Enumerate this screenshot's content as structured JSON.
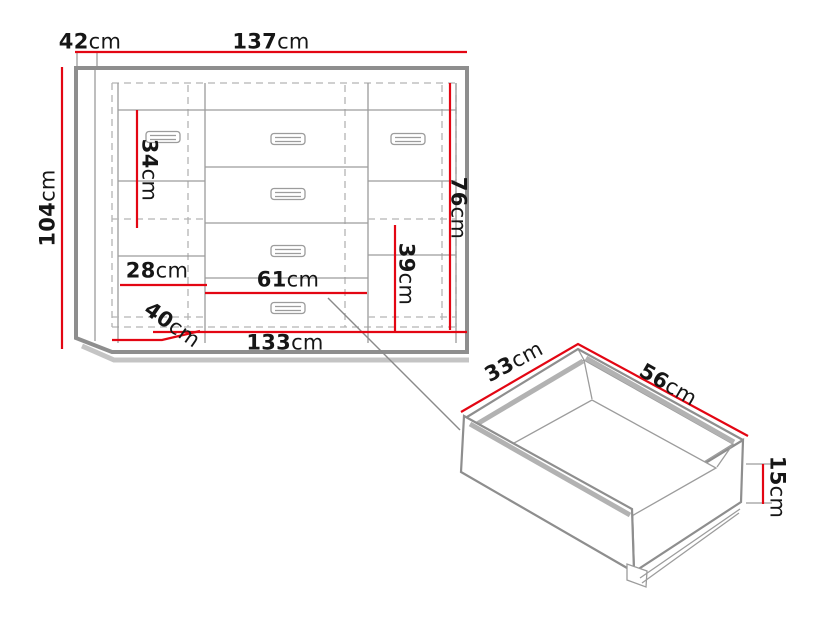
{
  "colors": {
    "dimension_line": "#e30613",
    "outline": "#8e8e8e",
    "label_text": "#161616"
  },
  "cabinet": {
    "dims": {
      "top_depth": {
        "value": "42",
        "unit": "cm"
      },
      "total_width": {
        "value": "137",
        "unit": "cm"
      },
      "total_height": {
        "value": "104",
        "unit": "cm"
      },
      "left_inner_height": {
        "value": "34",
        "unit": "cm"
      },
      "left_inner_width": {
        "value": "28",
        "unit": "cm"
      },
      "center_inner_width": {
        "value": "61",
        "unit": "cm"
      },
      "right_inner_lower_height": {
        "value": "39",
        "unit": "cm"
      },
      "right_inner_height": {
        "value": "76",
        "unit": "cm"
      },
      "base_depth": {
        "value": "40",
        "unit": "cm"
      },
      "base_width": {
        "value": "133",
        "unit": "cm"
      }
    }
  },
  "drawer": {
    "dims": {
      "depth": {
        "value": "33",
        "unit": "cm"
      },
      "width": {
        "value": "56",
        "unit": "cm"
      },
      "height": {
        "value": "15",
        "unit": "cm"
      }
    }
  }
}
